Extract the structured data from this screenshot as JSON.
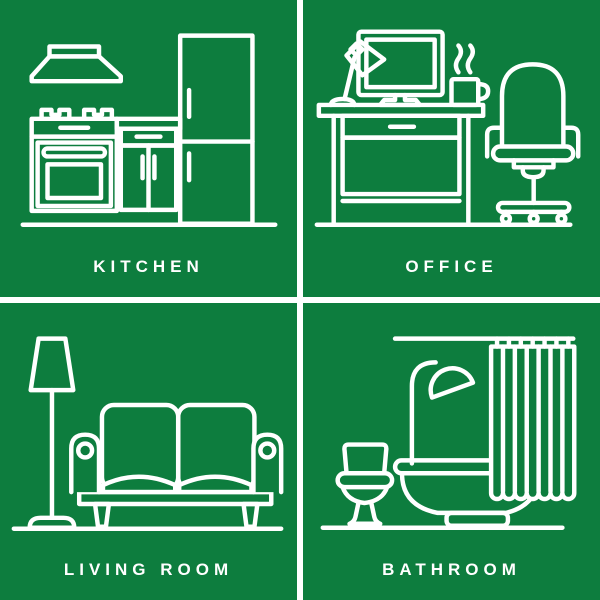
{
  "theme": {
    "background": "#0d7d3e",
    "line_color": "#ffffff",
    "divider_color": "#ffffff"
  },
  "panels": [
    {
      "id": "kitchen",
      "label": "KITCHEN",
      "icon": "kitchen-illustration"
    },
    {
      "id": "office",
      "label": "OFFICE",
      "icon": "office-illustration"
    },
    {
      "id": "living-room",
      "label": "LIVING ROOM",
      "icon": "living-room-illustration"
    },
    {
      "id": "bathroom",
      "label": "BATHROOM",
      "icon": "bathroom-illustration"
    }
  ]
}
